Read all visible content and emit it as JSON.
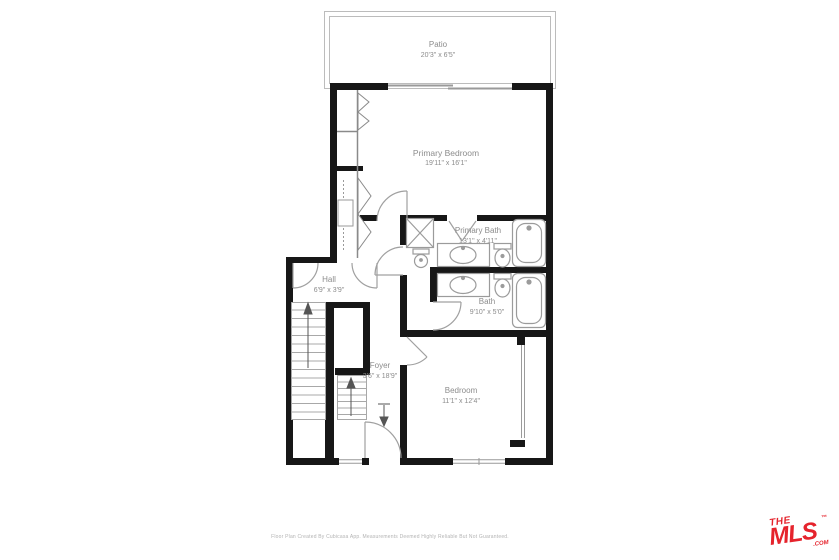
{
  "floorplan": {
    "rooms": [
      {
        "name": "Patio",
        "dims": "20'3\" x 6'5\""
      },
      {
        "name": "Primary Bedroom",
        "dims": "19'11\" x 16'1\""
      },
      {
        "name": "Primary Bath",
        "dims": "13'1\" x 4'11\""
      },
      {
        "name": "Hall",
        "dims": "6'9\" x 3'9\""
      },
      {
        "name": "Bath",
        "dims": "9'10\" x 5'0\""
      },
      {
        "name": "Foyer",
        "dims": "3'6\" x 18'9\""
      },
      {
        "name": "Bedroom",
        "dims": "11'1\" x 12'4\""
      }
    ],
    "footer_disclaimer": "Floor Plan Created By Cubicasa App. Measurements Deemed Highly Reliable But Not Guaranteed.",
    "logo": {
      "line1": "THE",
      "line2": "MLS",
      "tm": "™",
      "com": ".COM"
    },
    "colors": {
      "wall": "#171717",
      "fixture_stroke": "#9b9b9b",
      "door_arc": "#a0a0a0",
      "label_text": "#8c8c8c",
      "logo_red": "#e5232c"
    }
  }
}
